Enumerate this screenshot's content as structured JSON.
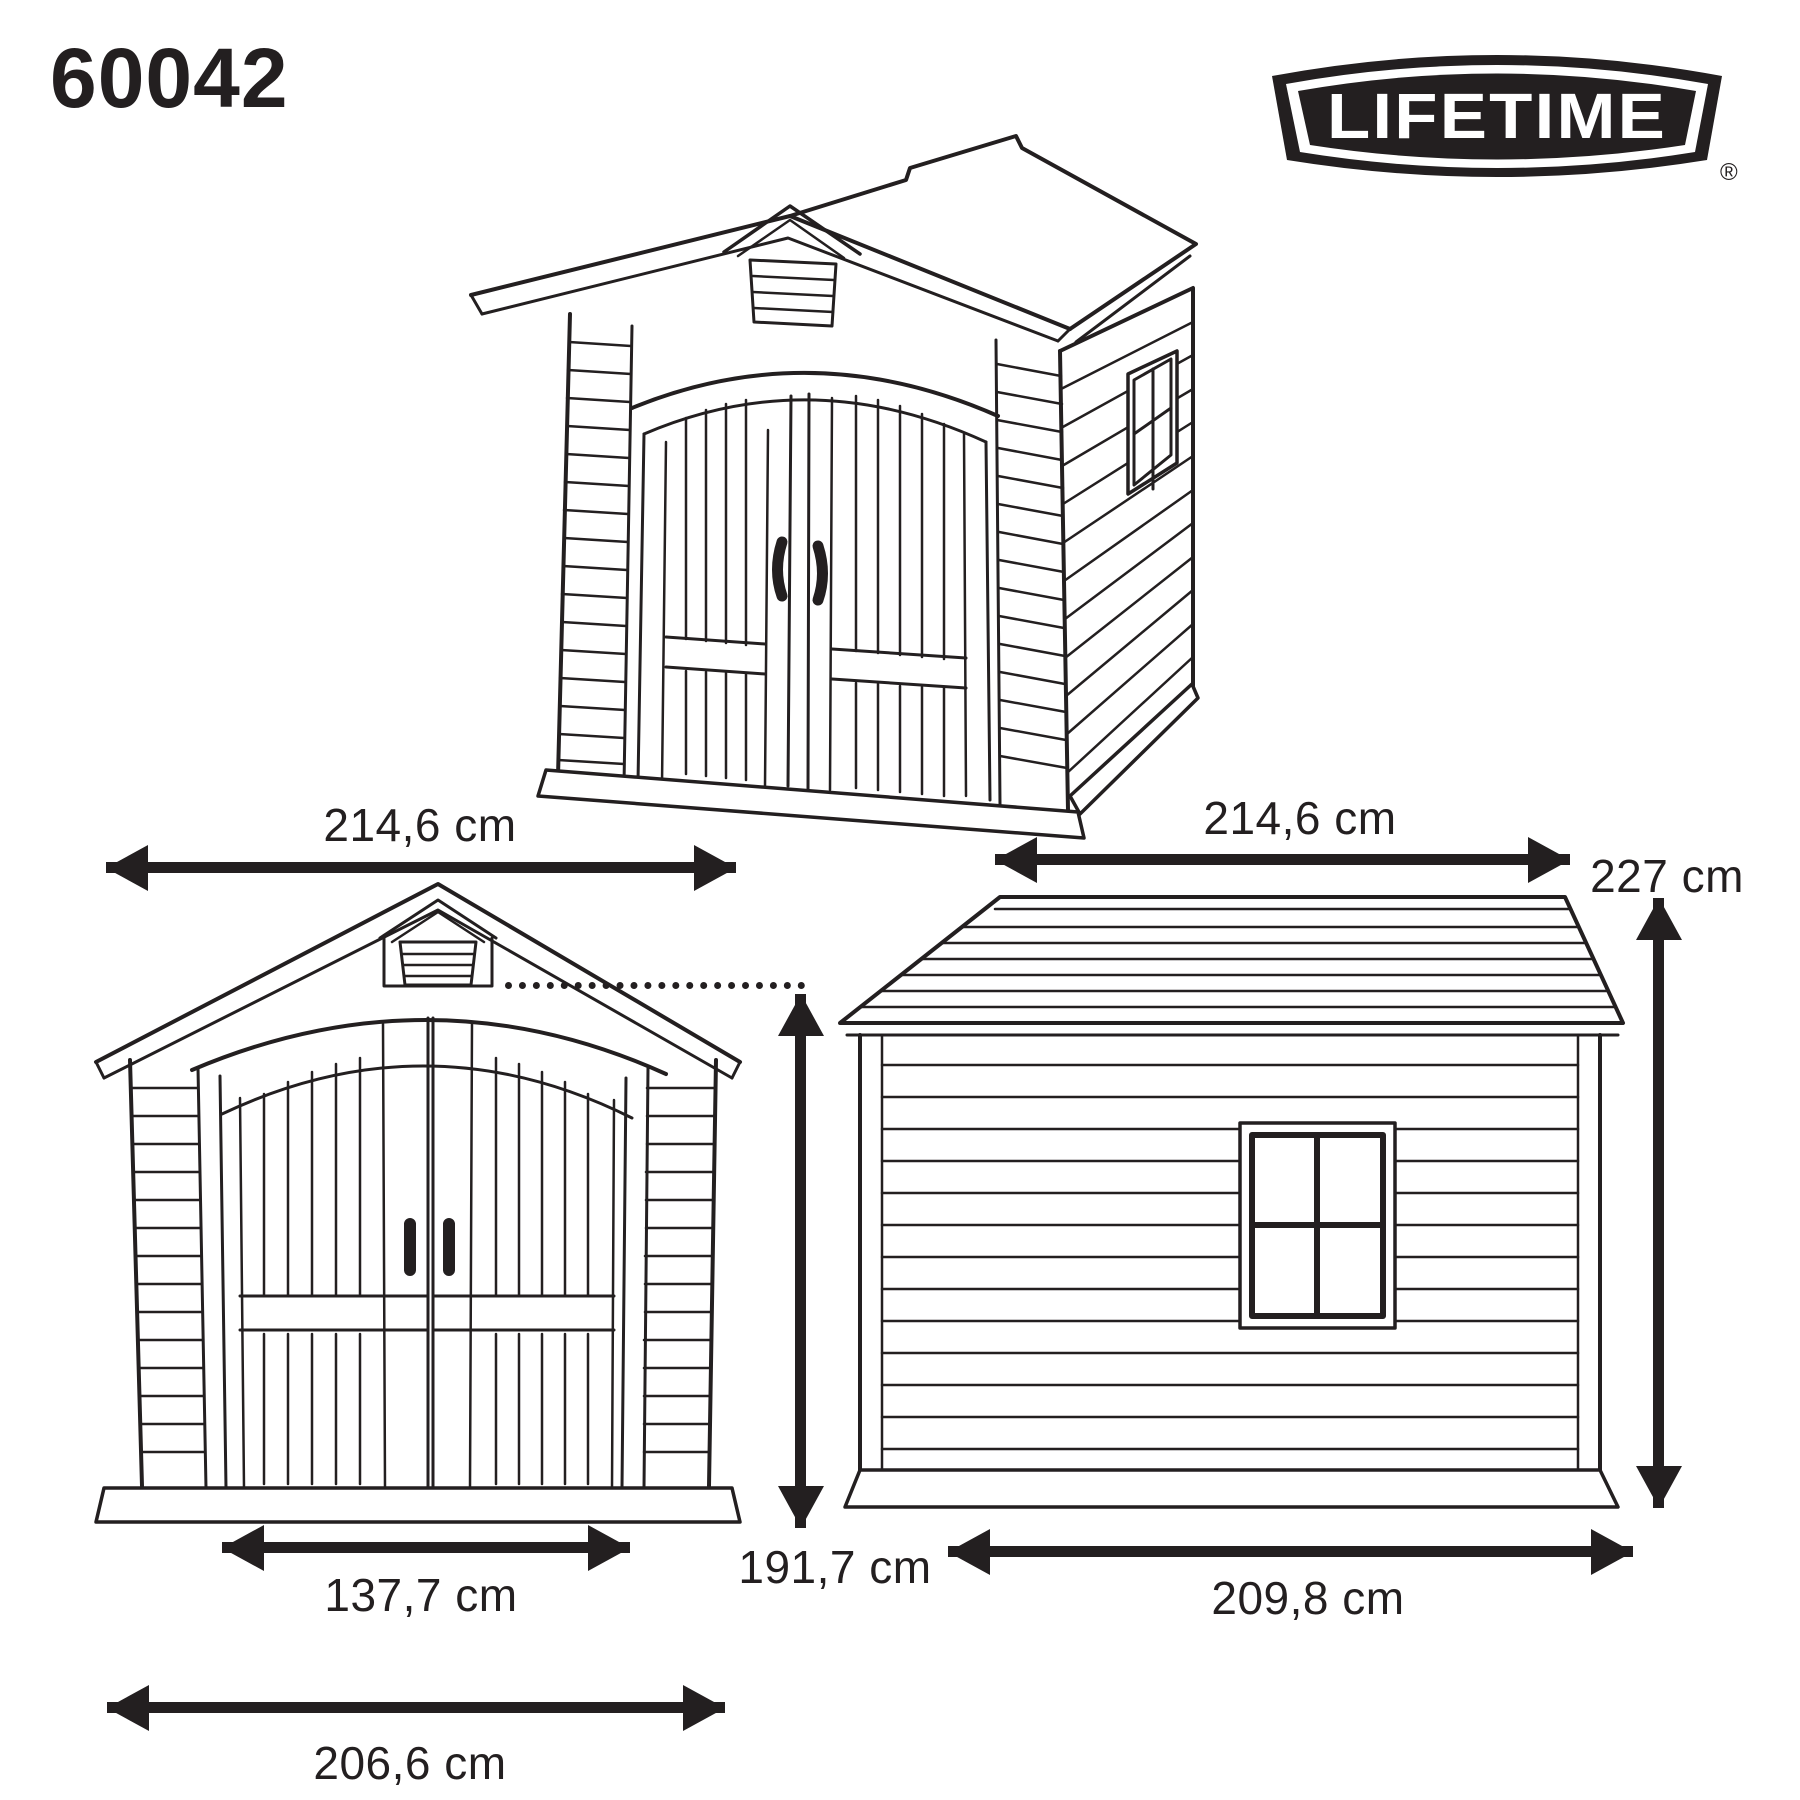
{
  "title": {
    "model_number": "60042"
  },
  "logo": {
    "brand": "LIFETIME",
    "registered": "®"
  },
  "dimensions": {
    "front_width_top": "214,6 cm",
    "front_door_width": "137,7 cm",
    "front_base_width": "206,6 cm",
    "front_wall_height": "191,7 cm",
    "side_width_top": "214,6 cm",
    "side_total_height": "227 cm",
    "side_base_width": "209,8 cm"
  },
  "views": {
    "iso": "isometric view of shed",
    "front": "front elevation of shed",
    "side": "side elevation of shed"
  },
  "colors": {
    "line_color": "#231f20",
    "background": "#ffffff"
  }
}
